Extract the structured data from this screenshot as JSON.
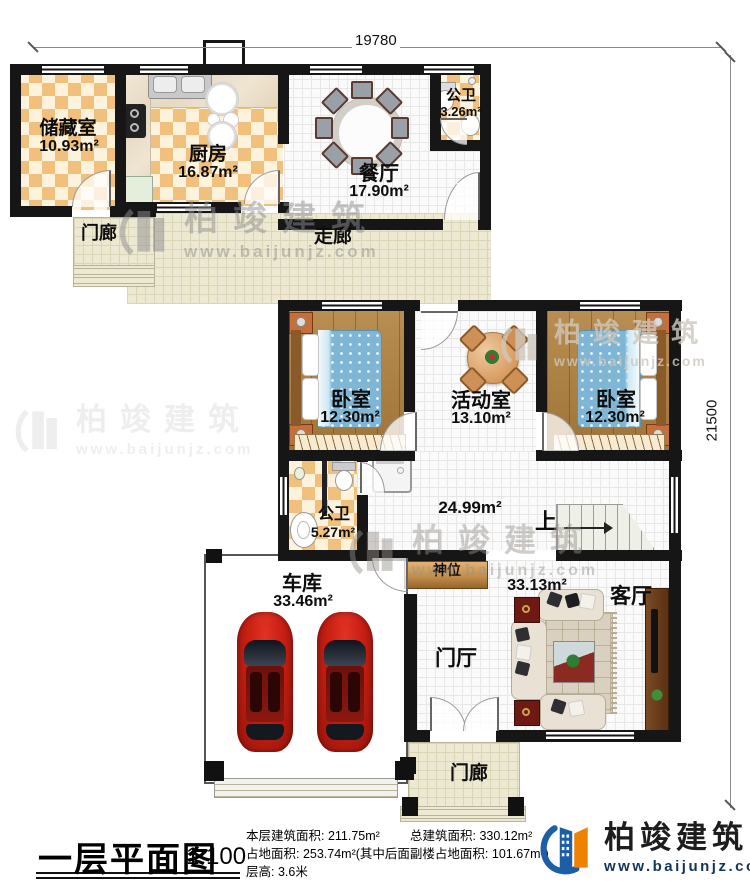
{
  "watermark": {
    "brand": "柏竣建筑",
    "url": "www.baijunjz.com"
  },
  "dims": {
    "top": "19780",
    "right": "21500"
  },
  "rooms": {
    "storage": {
      "name": "储藏室",
      "area": "10.93m²"
    },
    "kitchen": {
      "name": "厨房",
      "area": "16.87m²"
    },
    "dining": {
      "name": "餐厅",
      "area": "17.90m²"
    },
    "bath_top": {
      "name": "公卫",
      "area": "3.26m²"
    },
    "porch_top": {
      "name": "门廊"
    },
    "corridor": {
      "name": "走廊"
    },
    "bedroom_left": {
      "name": "卧室",
      "area": "12.30m²"
    },
    "activity": {
      "name": "活动室",
      "area": "13.10m²"
    },
    "bedroom_right": {
      "name": "卧室",
      "area": "12.30m²"
    },
    "bath_mid": {
      "name": "公卫",
      "area": "5.27m²"
    },
    "hall": {
      "area": "24.99m²"
    },
    "stairs": {
      "name": "上"
    },
    "shrine": {
      "name": "神位"
    },
    "garage": {
      "name": "车库",
      "area": "33.46m²"
    },
    "living": {
      "name": "客厅",
      "area": "33.13m²"
    },
    "foyer": {
      "name": "门厅"
    },
    "porch_bottom": {
      "name": "门廊"
    }
  },
  "footer": {
    "title": "一层平面图",
    "scale": "1:100",
    "stat1": "本层建筑面积: 211.75m²",
    "stat2": "总建筑面积: 330.12m²",
    "stat3": "占地面积: 253.74m²(其中后面副楼占地面积: 101.67m²)",
    "stat4": "层高: 3.6米",
    "logo_name": "柏竣建筑",
    "logo_url": "www.baijunjz.com"
  },
  "colors": {
    "wall": "#161616",
    "checker_tan": "#f1c07c",
    "wood": "#b1813f",
    "logo_blue": "#1c5fa8",
    "logo_orange": "#ef8200",
    "car_red": "#c51e12"
  }
}
